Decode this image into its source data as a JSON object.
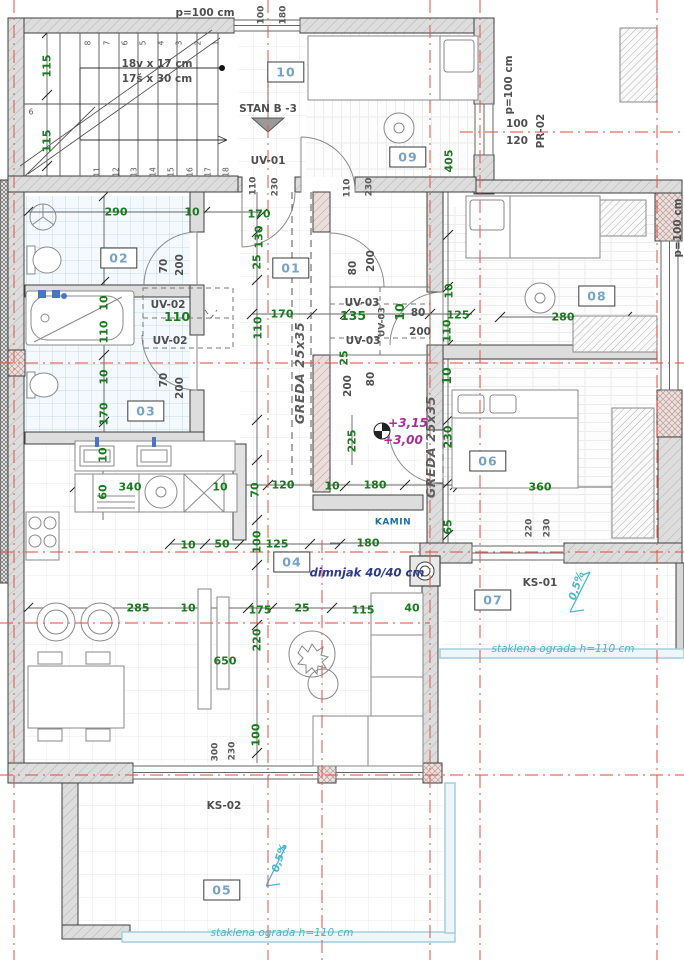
{
  "drawing": {
    "kind": "architectural floor plan",
    "colors": {
      "grid_red": "#e05648",
      "dim_green": "#1a7a1f",
      "room_tag_blue": "#76a3c8",
      "annotation_gray": "#4f4f4f",
      "level_magenta": "#aa2d97",
      "terrace_cyan": "#4ab5cd",
      "chimney_navy": "#2b3a8f",
      "wall_fill": "#dddddd"
    }
  },
  "rooms": [
    {
      "id": "01",
      "number": "01"
    },
    {
      "id": "02",
      "number": "02"
    },
    {
      "id": "03",
      "number": "03"
    },
    {
      "id": "04",
      "number": "04"
    },
    {
      "id": "05",
      "number": "05"
    },
    {
      "id": "06",
      "number": "06"
    },
    {
      "id": "07",
      "number": "07"
    },
    {
      "id": "08",
      "number": "08"
    },
    {
      "id": "09",
      "number": "09"
    },
    {
      "id": "10",
      "number": "10"
    }
  ],
  "labels": [
    {
      "id": "parapet-top",
      "text": "p=100 cm",
      "kind": "ann"
    },
    {
      "id": "win-top-w",
      "text": "100",
      "kind": "annS"
    },
    {
      "id": "win-top-h",
      "text": "180",
      "kind": "annS"
    },
    {
      "id": "stair-note-1",
      "text": "18v x 17 cm",
      "kind": "ann"
    },
    {
      "id": "stair-note-2",
      "text": "17š x 30 cm",
      "kind": "ann"
    },
    {
      "id": "dim-115-a",
      "text": "115",
      "kind": "dim"
    },
    {
      "id": "dim-115-b",
      "text": "115",
      "kind": "dim"
    },
    {
      "id": "stan-entry",
      "text": "STAN B -3",
      "kind": "ann"
    },
    {
      "id": "uv-01",
      "text": "UV-01",
      "kind": "ann"
    },
    {
      "id": "dim-405",
      "text": "405",
      "kind": "dim"
    },
    {
      "id": "parapet-09",
      "text": "p=100 cm",
      "kind": "ann"
    },
    {
      "id": "win-pr-w",
      "text": "100",
      "kind": "ann"
    },
    {
      "id": "win-pr-h",
      "text": "120",
      "kind": "ann"
    },
    {
      "id": "pr-02",
      "text": "PR-02",
      "kind": "ann"
    },
    {
      "id": "door-a-w",
      "text": "110",
      "kind": "annS"
    },
    {
      "id": "door-a-h",
      "text": "230",
      "kind": "annS"
    },
    {
      "id": "door-b-w",
      "text": "110",
      "kind": "annS"
    },
    {
      "id": "door-b-h",
      "text": "230",
      "kind": "annS"
    },
    {
      "id": "dim-290",
      "text": "290",
      "kind": "dim"
    },
    {
      "id": "dim-10-a",
      "text": "10",
      "kind": "dim"
    },
    {
      "id": "dim-170-a",
      "text": "170",
      "kind": "dim"
    },
    {
      "id": "door-02-w",
      "text": "70",
      "kind": "ann"
    },
    {
      "id": "door-02-h",
      "text": "200",
      "kind": "ann"
    },
    {
      "id": "dim-130",
      "text": "130",
      "kind": "dim"
    },
    {
      "id": "dim-25-a",
      "text": "25",
      "kind": "dim"
    },
    {
      "id": "door-01-w",
      "text": "80",
      "kind": "ann"
    },
    {
      "id": "door-01-h",
      "text": "200",
      "kind": "ann"
    },
    {
      "id": "uv-02-a",
      "text": "UV-02",
      "kind": "ann"
    },
    {
      "id": "dim-110-bold",
      "text": "110",
      "kind": "dimb"
    },
    {
      "id": "uv-02-b",
      "text": "UV-02",
      "kind": "ann"
    },
    {
      "id": "dim-10-b",
      "text": "10",
      "kind": "dim"
    },
    {
      "id": "dim-110-a",
      "text": "110",
      "kind": "dim"
    },
    {
      "id": "dim-10-c",
      "text": "10",
      "kind": "dim"
    },
    {
      "id": "dim-170-b",
      "text": "170",
      "kind": "dim"
    },
    {
      "id": "door-03-w",
      "text": "70",
      "kind": "ann"
    },
    {
      "id": "door-03-h",
      "text": "200",
      "kind": "ann"
    },
    {
      "id": "dim-170-c",
      "text": "170",
      "kind": "dim"
    },
    {
      "id": "dim-110-c",
      "text": "110",
      "kind": "dim"
    },
    {
      "id": "uv-03-a",
      "text": "UV-03",
      "kind": "ann"
    },
    {
      "id": "dim-135",
      "text": "135",
      "kind": "dimb"
    },
    {
      "id": "uv-03-b",
      "text": "UV-03",
      "kind": "ann"
    },
    {
      "id": "uv-03-c",
      "text": "UV-03",
      "kind": "annS"
    },
    {
      "id": "greda-a",
      "text": "GREDA 25x35",
      "kind": "beam"
    },
    {
      "id": "dim-10-d",
      "text": "10",
      "kind": "dimb"
    },
    {
      "id": "door-hall-w",
      "text": "80",
      "kind": "ann"
    },
    {
      "id": "door-hall-h",
      "text": "200",
      "kind": "ann"
    },
    {
      "id": "dim-125-a",
      "text": "125",
      "kind": "dim"
    },
    {
      "id": "dim-110-d",
      "text": "110",
      "kind": "dim"
    },
    {
      "id": "dim-25-b",
      "text": "25",
      "kind": "dim"
    },
    {
      "id": "door-06-w",
      "text": "80",
      "kind": "ann"
    },
    {
      "id": "door-06-h",
      "text": "200",
      "kind": "ann"
    },
    {
      "id": "dim-10-e",
      "text": "10",
      "kind": "dimb"
    },
    {
      "id": "dim-10-f",
      "text": "10",
      "kind": "dim"
    },
    {
      "id": "dim-280",
      "text": "280",
      "kind": "dim"
    },
    {
      "id": "dim-230-a",
      "text": "230",
      "kind": "dim"
    },
    {
      "id": "dim-225",
      "text": "225",
      "kind": "dim"
    },
    {
      "id": "greda-b",
      "text": "GREDA 25x35",
      "kind": "beam"
    },
    {
      "id": "level-upper",
      "text": "+3,15",
      "kind": "lvl"
    },
    {
      "id": "level-lower",
      "text": "+3,00",
      "kind": "lvl"
    },
    {
      "id": "dim-180-a",
      "text": "180",
      "kind": "dim"
    },
    {
      "id": "dim-120",
      "text": "120",
      "kind": "dim"
    },
    {
      "id": "dim-10-g",
      "text": "10",
      "kind": "dim"
    },
    {
      "id": "dim-70-c",
      "text": "70",
      "kind": "dim"
    },
    {
      "id": "dim-65",
      "text": "65",
      "kind": "dim"
    },
    {
      "id": "dim-360",
      "text": "360",
      "kind": "dim"
    },
    {
      "id": "kamin",
      "text": "KAMIN",
      "kind": "kamin"
    },
    {
      "id": "dim-100-a",
      "text": "100",
      "kind": "dim"
    },
    {
      "id": "dim-125-b",
      "text": "125",
      "kind": "dim"
    },
    {
      "id": "dim-180-b",
      "text": "180",
      "kind": "dim"
    },
    {
      "id": "dimnjak",
      "text": "dimnjak 40/40 cm",
      "kind": "navy"
    },
    {
      "id": "win-06-w",
      "text": "220",
      "kind": "annS"
    },
    {
      "id": "win-06-h",
      "text": "230",
      "kind": "annS"
    },
    {
      "id": "ks-01",
      "text": "KS-01",
      "kind": "ann"
    },
    {
      "id": "slope-ks01",
      "text": "0,5%",
      "kind": "cyan"
    },
    {
      "id": "railing-ks01",
      "text": "staklena ograda h=110 cm",
      "kind": "cyanS"
    },
    {
      "id": "dim-10-h",
      "text": "10",
      "kind": "dim"
    },
    {
      "id": "dim-340",
      "text": "340",
      "kind": "dim"
    },
    {
      "id": "dim-60",
      "text": "60",
      "kind": "dim"
    },
    {
      "id": "dim-10-i",
      "text": "10",
      "kind": "dim"
    },
    {
      "id": "dim-10-j",
      "text": "10",
      "kind": "dim"
    },
    {
      "id": "dim-50",
      "text": "50",
      "kind": "dim"
    },
    {
      "id": "dim-285",
      "text": "285",
      "kind": "dim"
    },
    {
      "id": "dim-10-k",
      "text": "10",
      "kind": "dim"
    },
    {
      "id": "dim-650",
      "text": "650",
      "kind": "dim"
    },
    {
      "id": "dim-175",
      "text": "175",
      "kind": "dim"
    },
    {
      "id": "dim-25-c",
      "text": "25",
      "kind": "dim"
    },
    {
      "id": "dim-115-c",
      "text": "115",
      "kind": "dim"
    },
    {
      "id": "dim-40",
      "text": "40",
      "kind": "dim"
    },
    {
      "id": "dim-220",
      "text": "220",
      "kind": "dim"
    },
    {
      "id": "dim-100-b",
      "text": "100",
      "kind": "dim"
    },
    {
      "id": "win-ks02-w",
      "text": "300",
      "kind": "annS"
    },
    {
      "id": "win-ks02-h",
      "text": "230",
      "kind": "annS"
    },
    {
      "id": "ks-02",
      "text": "KS-02",
      "kind": "ann"
    },
    {
      "id": "slope-ks02",
      "text": "0,5%",
      "kind": "cyan"
    },
    {
      "id": "railing-ks02",
      "text": "staklena ograda h=110 cm",
      "kind": "cyanS"
    },
    {
      "id": "parapet-right",
      "text": "p=100 cm",
      "kind": "ann"
    },
    {
      "id": "step-1",
      "text": "1",
      "kind": "tiny"
    },
    {
      "id": "step-2",
      "text": "2",
      "kind": "tiny"
    },
    {
      "id": "step-3",
      "text": "3",
      "kind": "tiny"
    },
    {
      "id": "step-4",
      "text": "4",
      "kind": "tiny"
    },
    {
      "id": "step-5",
      "text": "5",
      "kind": "tiny"
    },
    {
      "id": "step-6",
      "text": "6",
      "kind": "tiny"
    },
    {
      "id": "step-7",
      "text": "7",
      "kind": "tiny"
    },
    {
      "id": "step-8",
      "text": "8",
      "kind": "tiny"
    },
    {
      "id": "step-11",
      "text": "11",
      "kind": "tiny"
    },
    {
      "id": "step-12",
      "text": "12",
      "kind": "tiny"
    },
    {
      "id": "step-13",
      "text": "13",
      "kind": "tiny"
    },
    {
      "id": "step-14",
      "text": "14",
      "kind": "tiny"
    },
    {
      "id": "step-15",
      "text": "15",
      "kind": "tiny"
    },
    {
      "id": "step-16",
      "text": "16",
      "kind": "tiny"
    },
    {
      "id": "step-17",
      "text": "17",
      "kind": "tiny"
    },
    {
      "id": "step-18",
      "text": "18",
      "kind": "tiny"
    },
    {
      "id": "step-6l",
      "text": "6",
      "kind": "tiny"
    }
  ]
}
